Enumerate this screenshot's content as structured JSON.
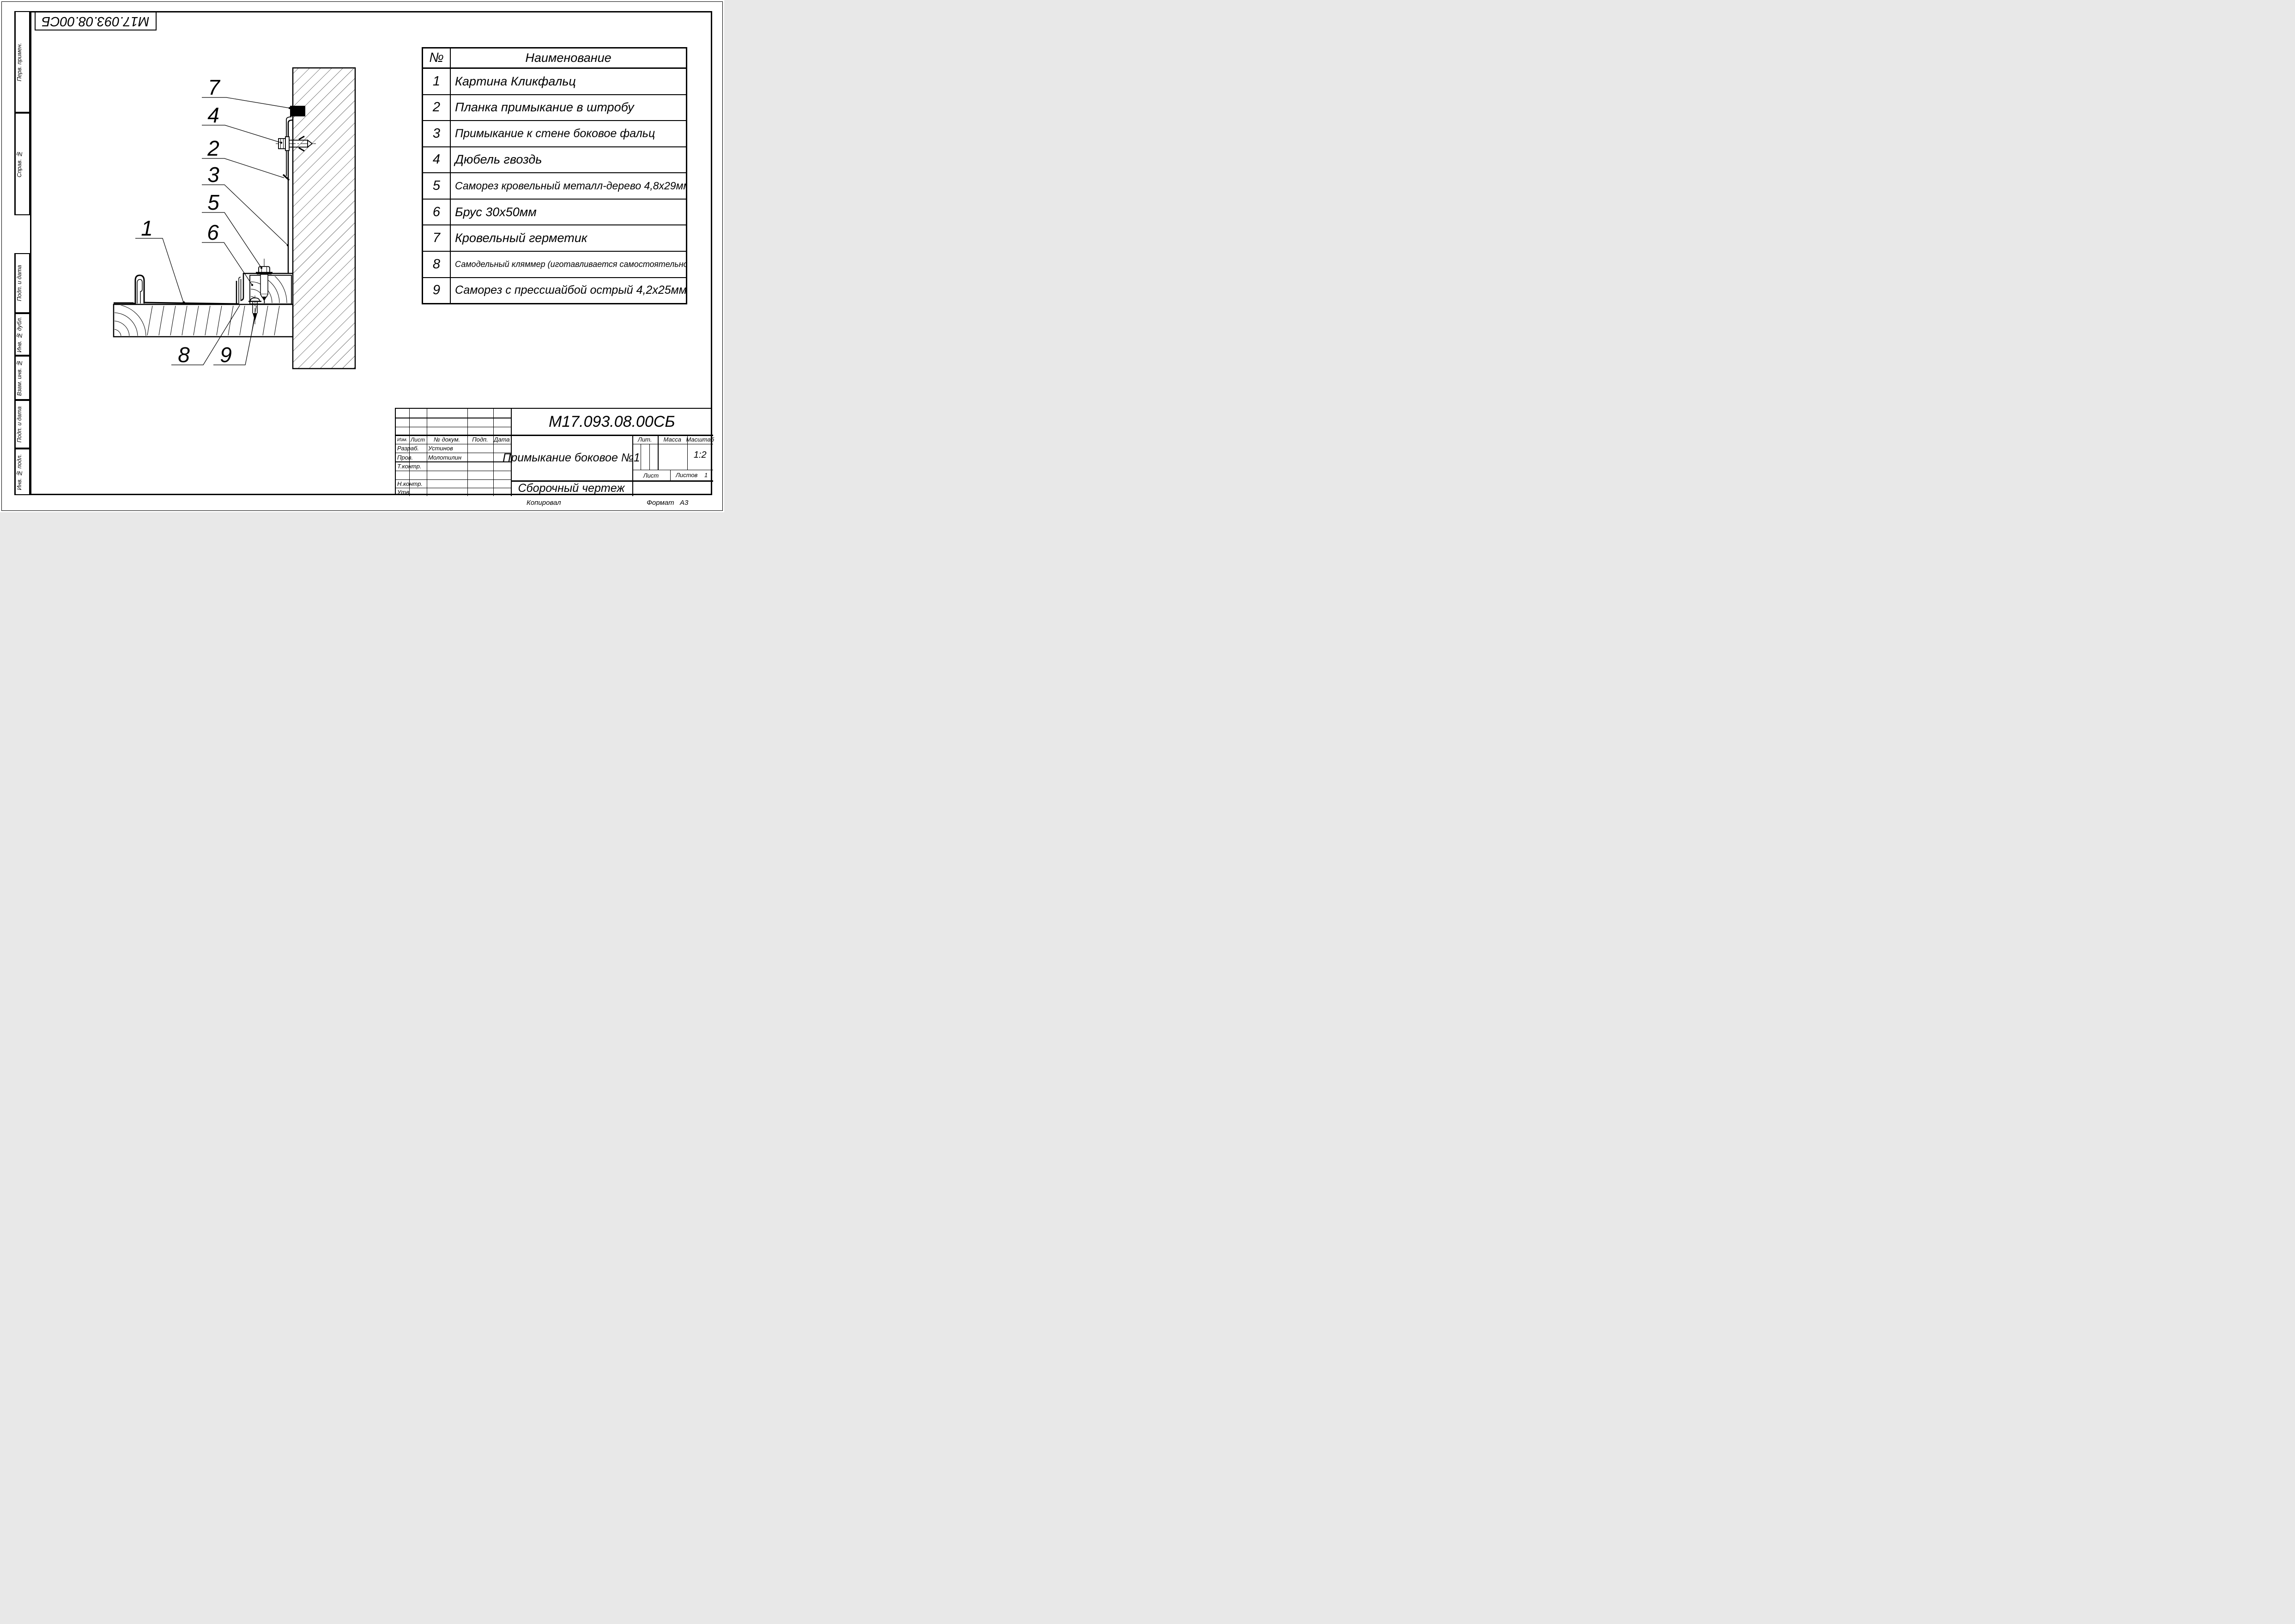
{
  "page": {
    "copied": "Копировал",
    "format_label": "Формат",
    "format_value": "А3"
  },
  "corner_stamp": {
    "doc_number": "М17.093.08.00СБ"
  },
  "margin_stamps": {
    "perv_primen": "Перв. примен.",
    "sprav_no": "Справ. №",
    "podp_data_1": "Подп. и дата",
    "inv_no_dubl": "Инв. № дубл.",
    "vzam_inv_no": "Взам. инв. №",
    "podp_data_2": "Подп. и дата",
    "inv_no_podl": "Инв. № подл."
  },
  "parts_table": {
    "header_num": "№",
    "header_name": "Наименование",
    "rows": [
      {
        "num": "1",
        "name": "Картина Кликфальц"
      },
      {
        "num": "2",
        "name": "Планка примыкание в штробу"
      },
      {
        "num": "3",
        "name": "Примыкание к стене боковое фальц"
      },
      {
        "num": "4",
        "name": "Дюбель гвоздь"
      },
      {
        "num": "5",
        "name": "Саморез кровельный металл-дерево 4,8х29мм"
      },
      {
        "num": "6",
        "name": "Брус 30х50мм"
      },
      {
        "num": "7",
        "name": "Кровельный герметик"
      },
      {
        "num": "8",
        "name": "Самодельный кляммер (иготавливается самостоятельно)"
      },
      {
        "num": "9",
        "name": "Саморез с прессшайбой острый 4,2х25мм"
      }
    ]
  },
  "title_block": {
    "doc_number": "М17.093.08.00СБ",
    "name": "Примыкание боковое №1",
    "doc_type": "Сборочный чертеж",
    "scale": "1:2",
    "sheets_count": "1",
    "col_izm": "Изм.",
    "col_list": "Лист",
    "col_docnum": "№ докум.",
    "col_podp": "Подп.",
    "col_data": "Дата",
    "row_razrab": "Разраб.",
    "row_prov": "Пров.",
    "row_tkontr": "Т.контр.",
    "row_nkontr": "Н.контр.",
    "row_utv": "Утв.",
    "developer": "Устинов",
    "checker": "Молотилин",
    "lit_label": "Лит.",
    "mass_label": "Масса",
    "scale_label": "Масштаб",
    "list_label": "Лист",
    "listov_label": "Листов"
  },
  "drawing": {
    "callouts": {
      "n1": "1",
      "n2": "2",
      "n3": "3",
      "n4": "4",
      "n5": "5",
      "n6": "6",
      "n7": "7",
      "n8": "8",
      "n9": "9"
    }
  }
}
